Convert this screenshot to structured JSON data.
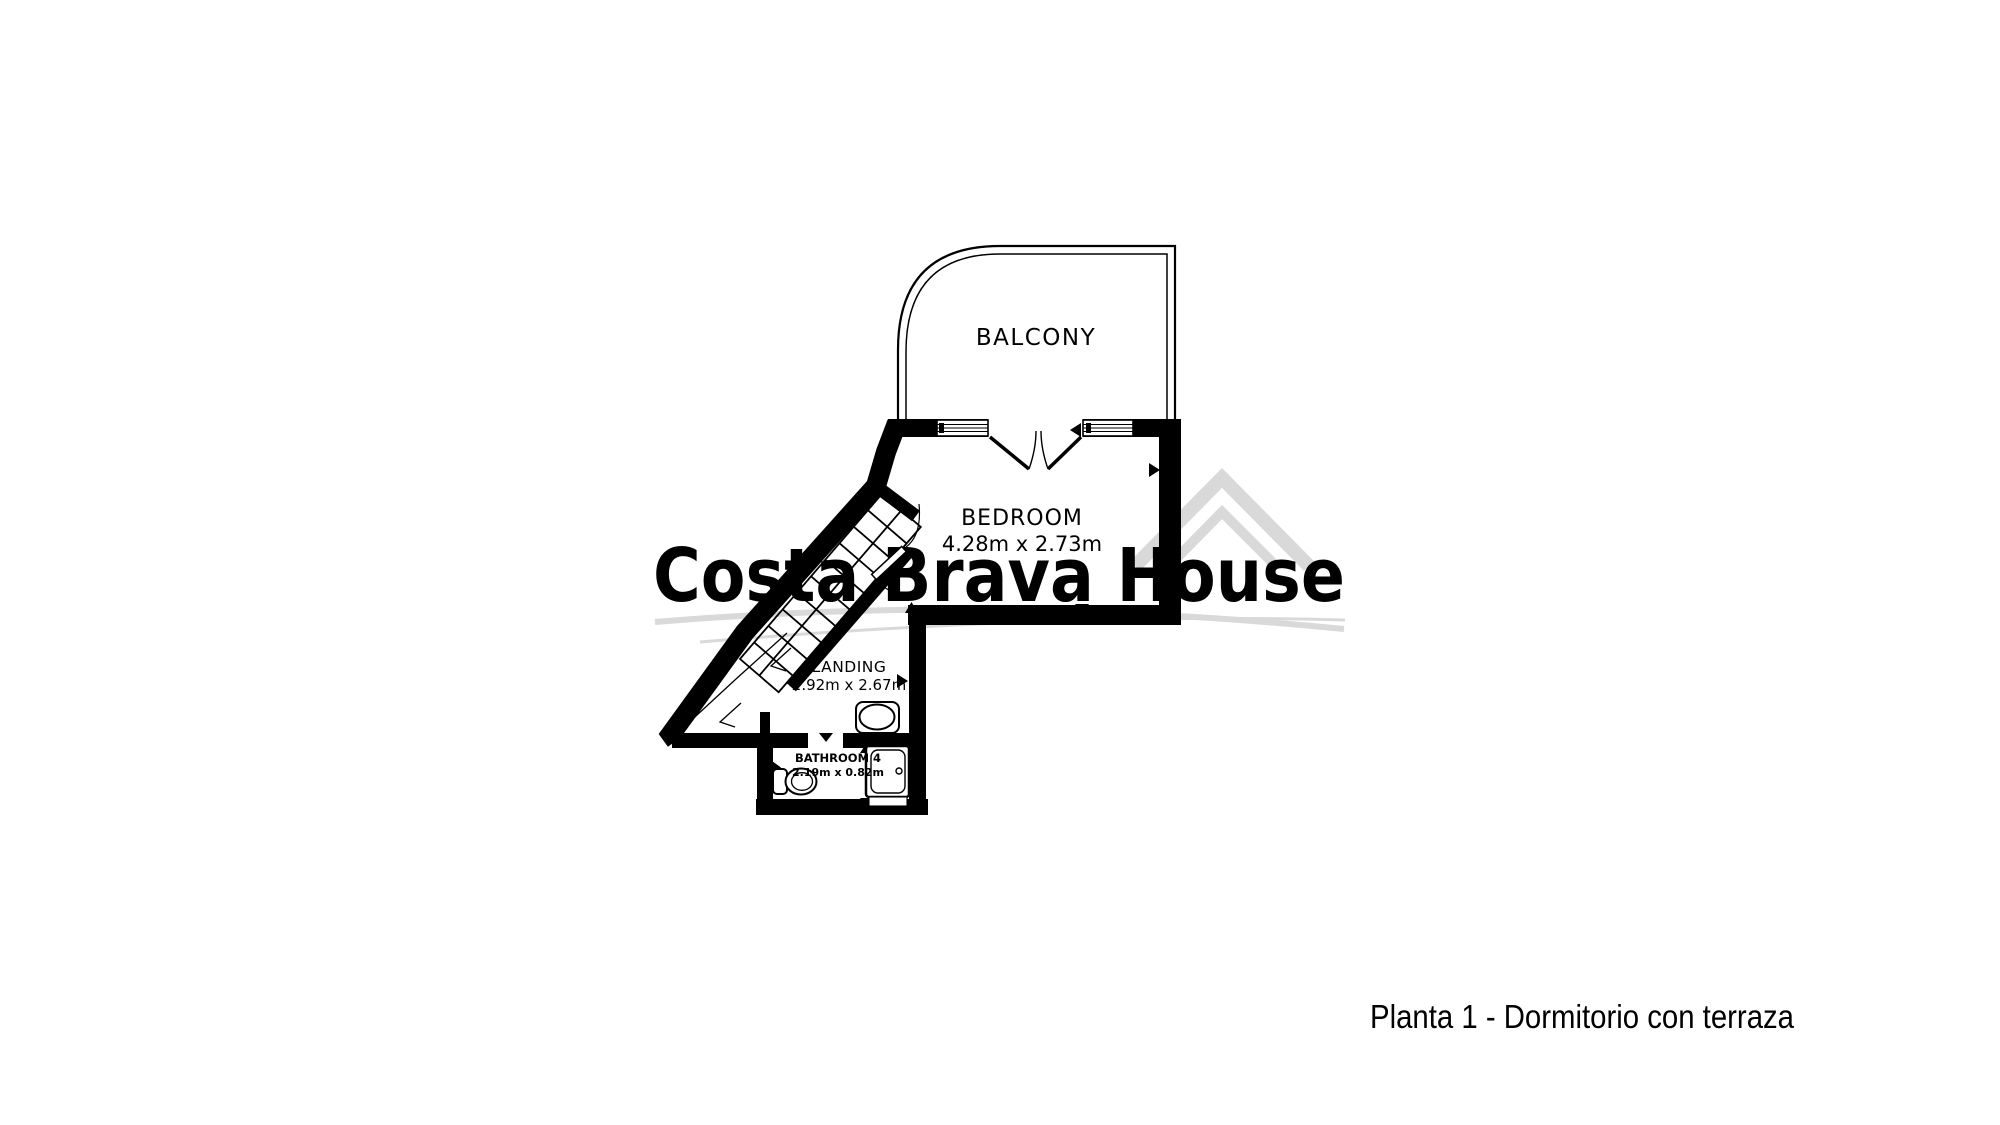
{
  "watermark": {
    "text": "Costa Brava House",
    "color": "#d9d9d9"
  },
  "rooms": {
    "balcony": {
      "label": "BALCONY"
    },
    "bedroom": {
      "label": "BEDROOM",
      "dimensions": "4.28m x 2.73m"
    },
    "landing": {
      "label": "LANDING",
      "dimensions": "2.92m x 2.67m"
    },
    "bathroom": {
      "label": "BATHROOM 4",
      "dimensions": "2.19m x 0.82m"
    }
  },
  "caption": "Planta 1 - Dormitorio con terraza",
  "colors": {
    "walls": "#000000",
    "background": "#ffffff",
    "watermark": "#d9d9d9"
  }
}
